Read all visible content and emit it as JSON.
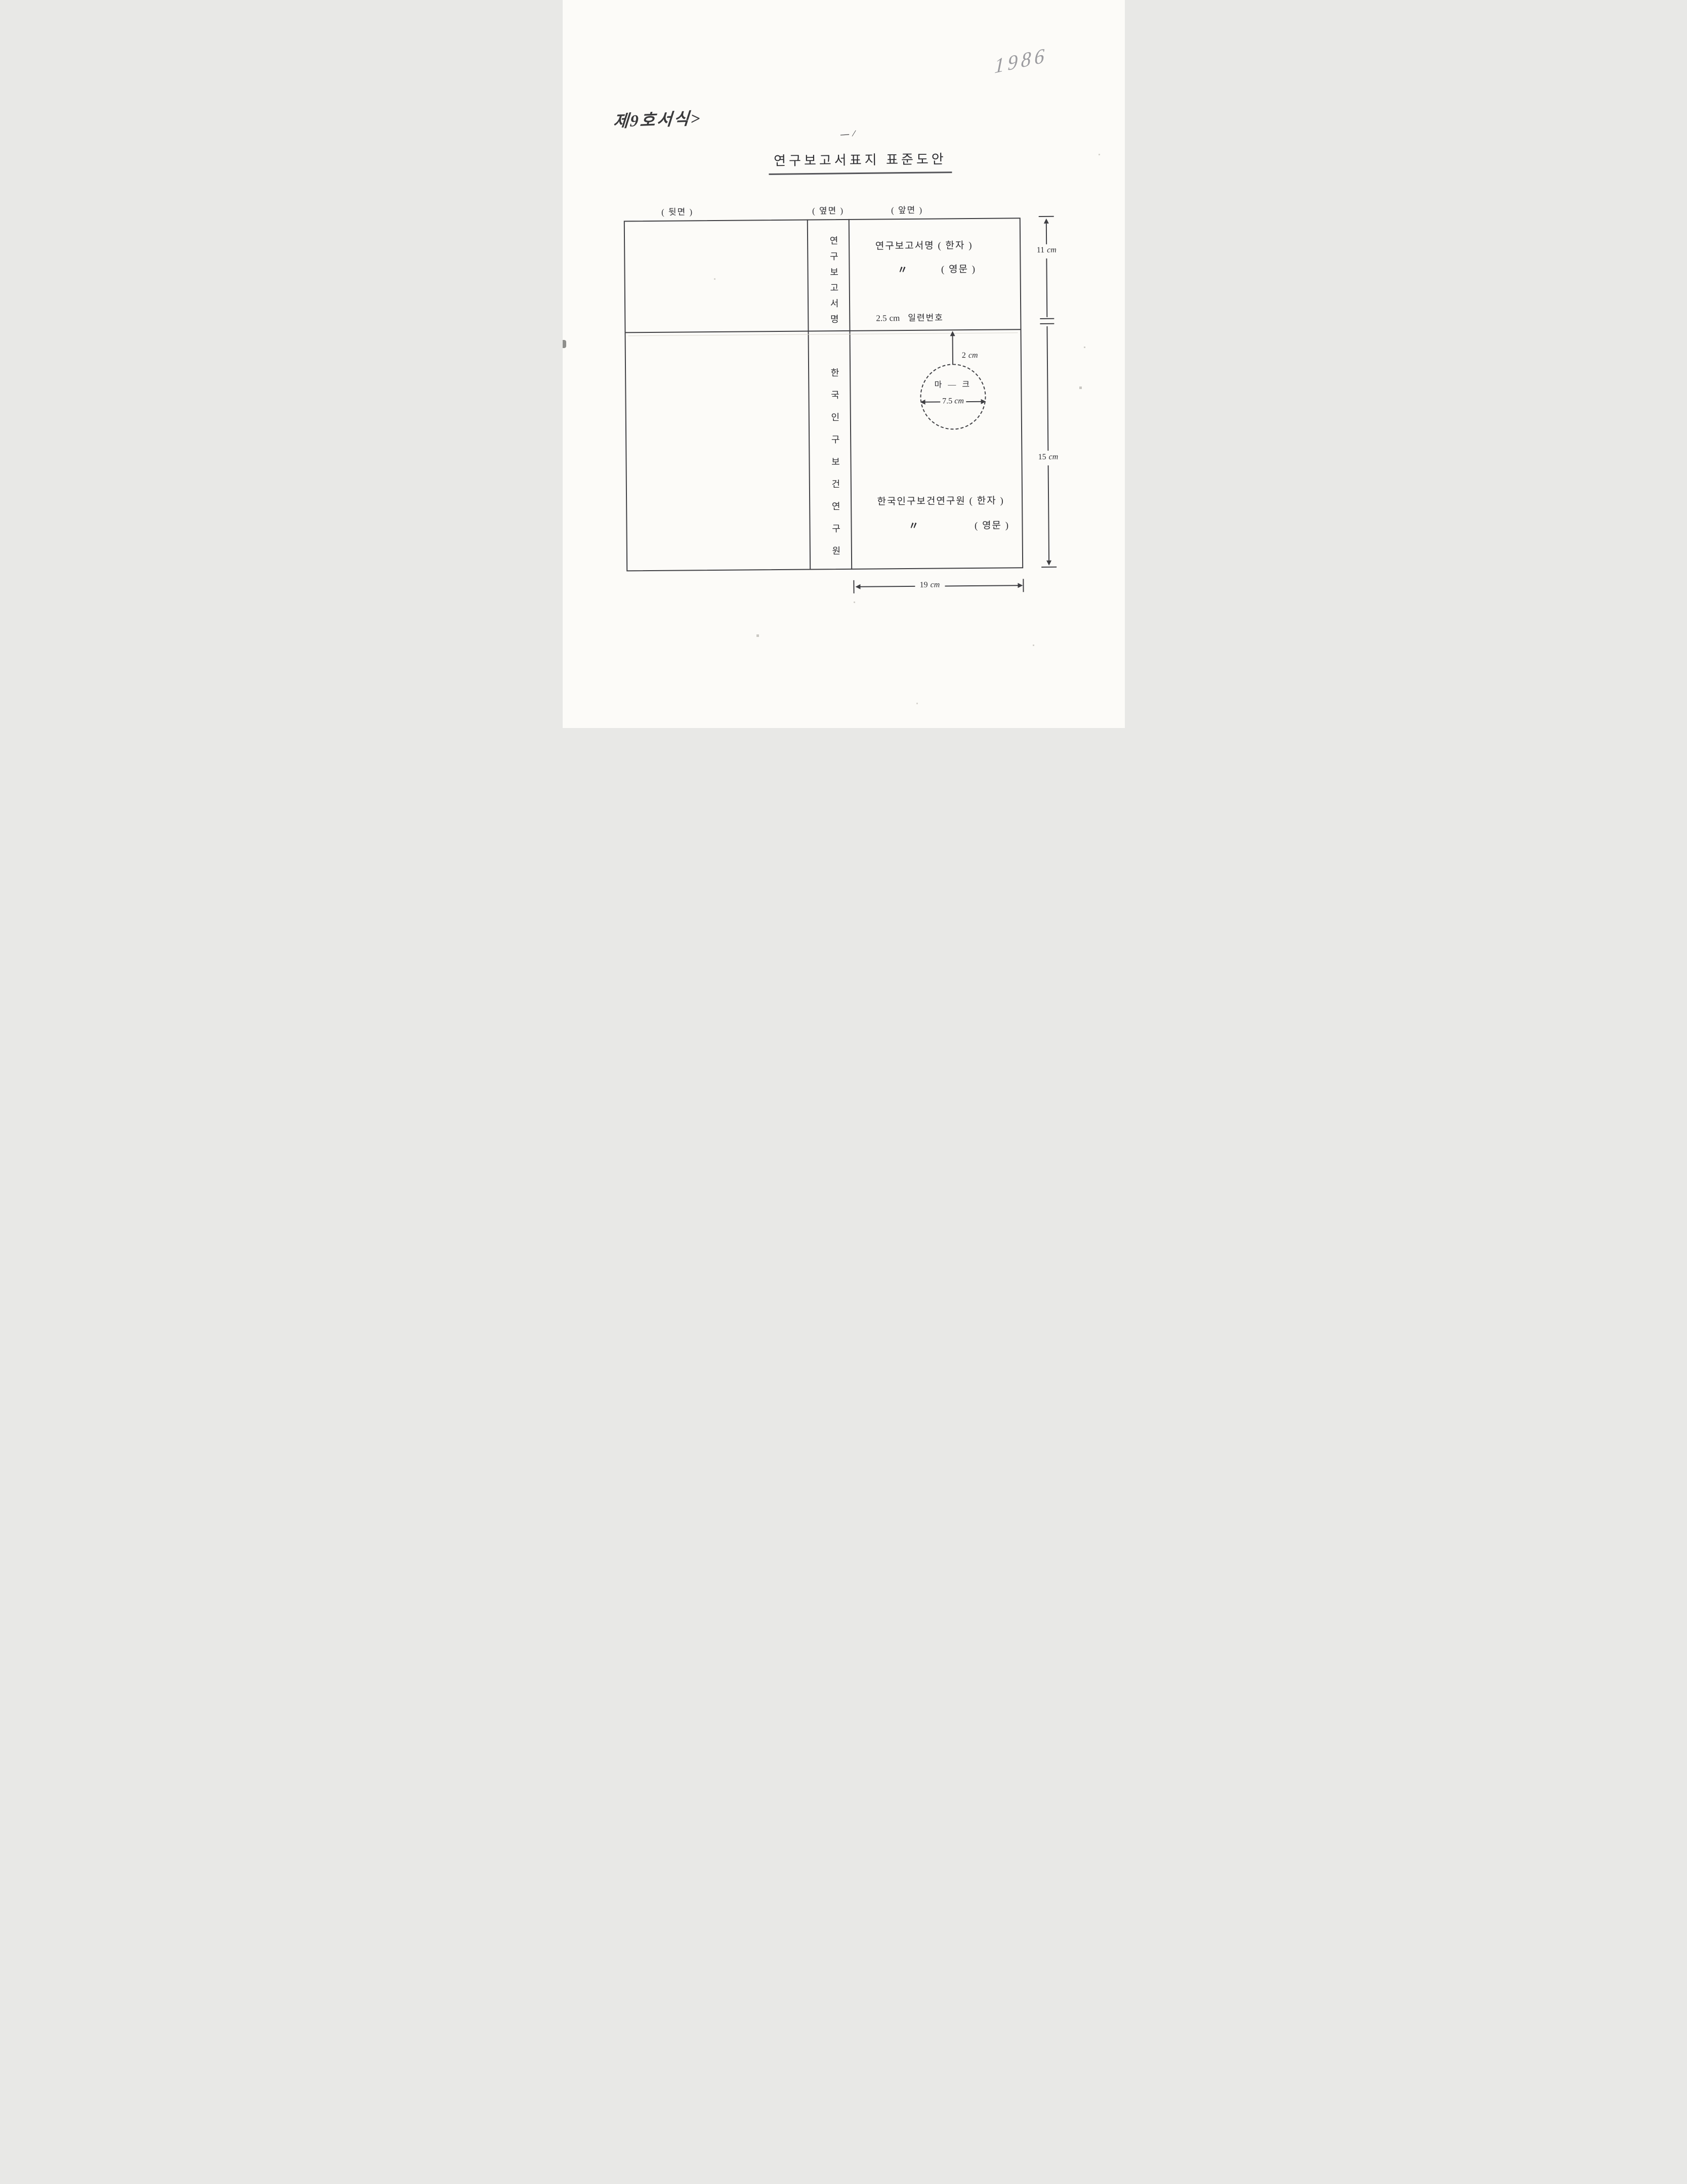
{
  "annotations": {
    "year_note": "1986",
    "form_note": "제9호서식>",
    "stray_mark": "— ∕"
  },
  "title": "연구보고서표지 표준도안",
  "panel_labels": {
    "back": "( 뒷면 )",
    "side": "( 옆면 )",
    "front": "( 앞면 )"
  },
  "spine": {
    "top_text": "연구보고서명",
    "bottom_text": "한국인구보건연구원"
  },
  "front_panel": {
    "report_title_hanja": "연구보고서명 ( 한자 )",
    "ditto_mark": "〃",
    "report_title_english": "( 영문 )",
    "serial": {
      "value": "2.5",
      "unit": "cm",
      "label": "일련번호"
    },
    "mark_offset": {
      "value": "2",
      "unit": "cm"
    },
    "mark_label": "마 ― 크",
    "mark_diameter": {
      "value": "7.5",
      "unit": "cm"
    },
    "org_hanja": "한국인구보건연구원 ( 한자 )",
    "org_english": "( 영문 )"
  },
  "dimensions": {
    "top_section": {
      "value": "11",
      "unit": "cm"
    },
    "bottom_section": {
      "value": "15",
      "unit": "cm"
    },
    "front_width": {
      "value": "19",
      "unit": "cm"
    }
  }
}
